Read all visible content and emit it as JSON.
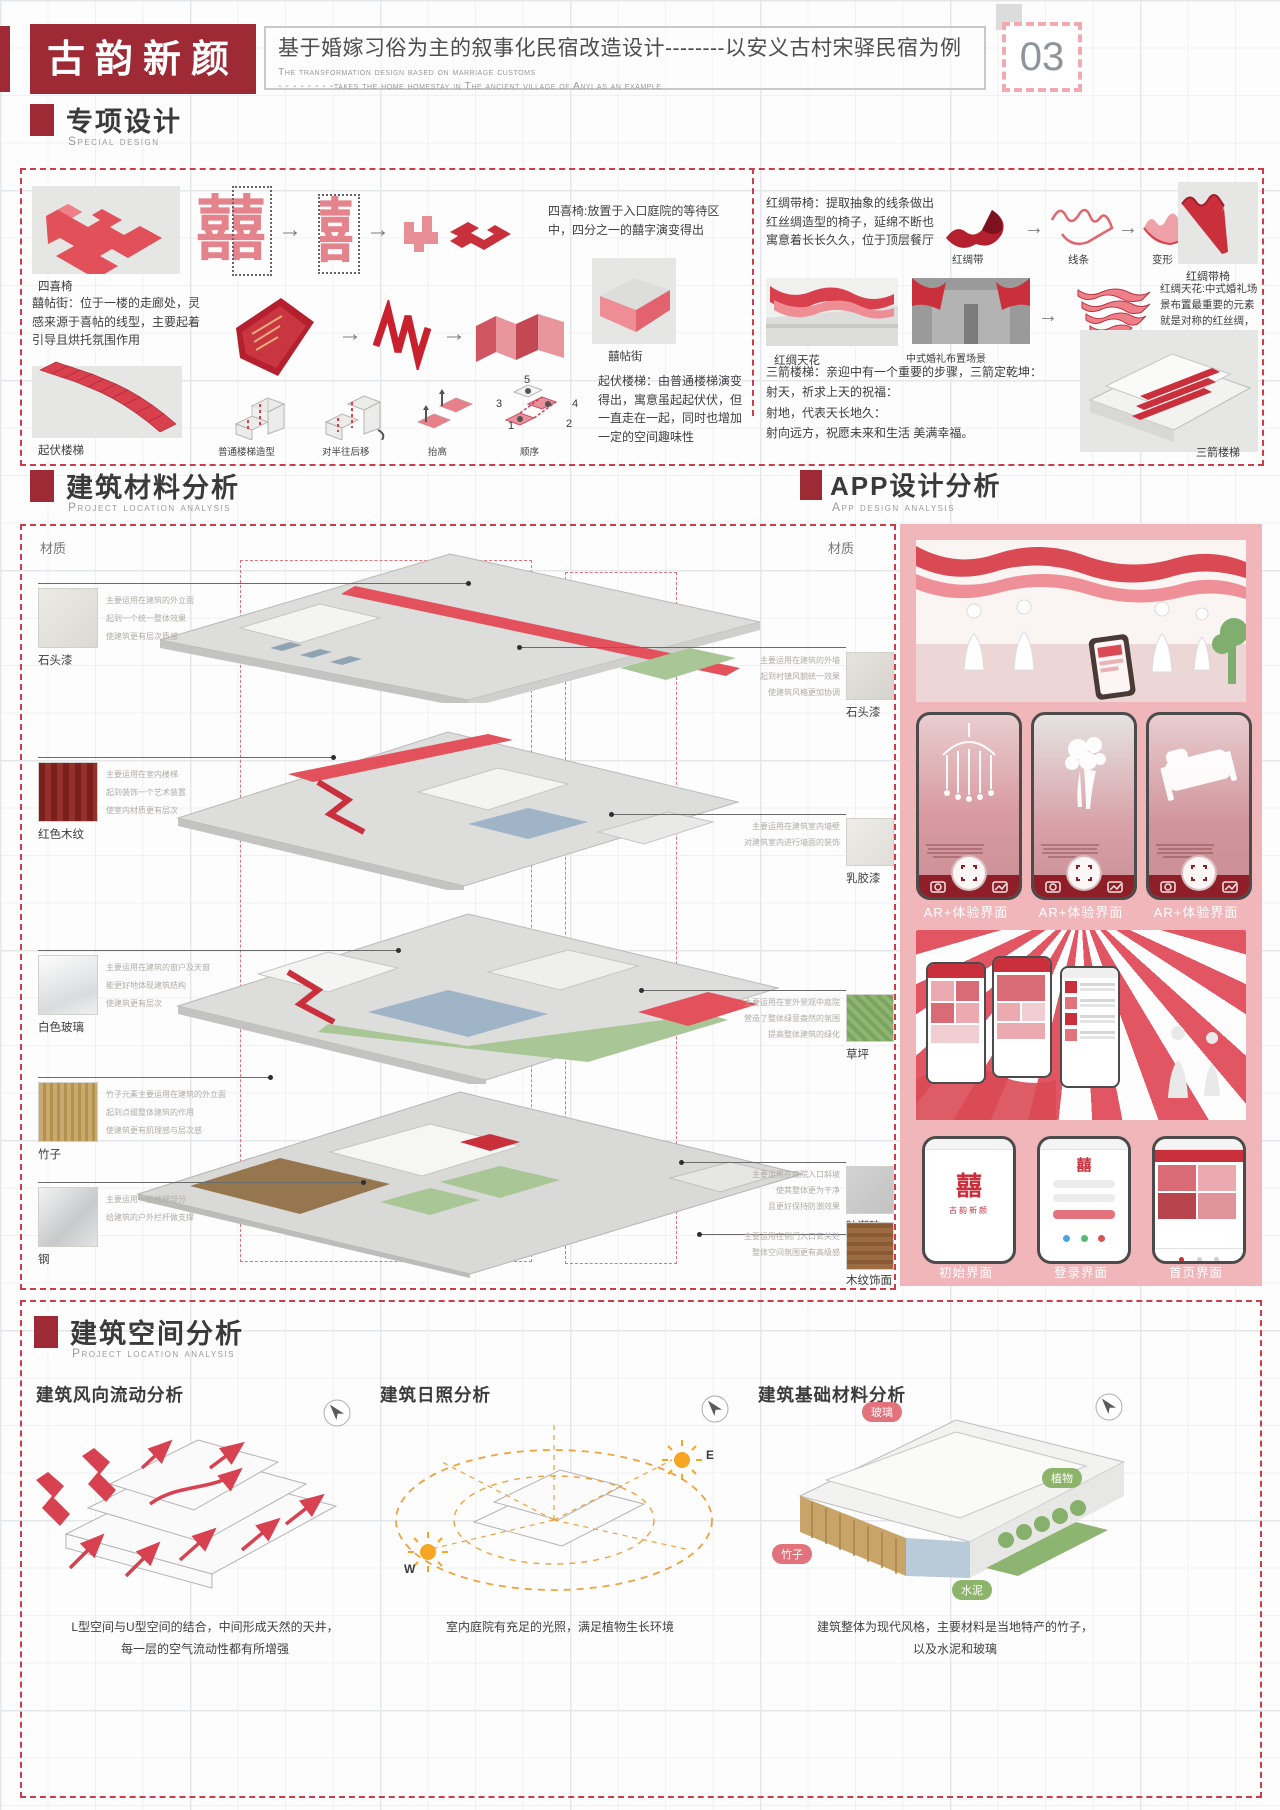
{
  "icons": {
    "arrow_right": "→"
  },
  "header": {
    "logo": "古韵新颜",
    "title_cn": "基于婚嫁习俗为主的叙事化民宿改造设计--------以安义古村宋驿民宿为例",
    "subtitle_en_1": "The transformation design based on marriage customs",
    "subtitle_en_2": "- - - - - - - -takes the home homestay in The ancient village of Anyi as an example",
    "page_number": "03"
  },
  "special": {
    "title": "专项设计",
    "subtitle": "Special design",
    "sixi": {
      "label": "四喜椅",
      "glyph": "囍",
      "desc": "四喜椅:放置于入口庭院的等待区中，四分之一的囍字演变得出"
    },
    "xitie": {
      "desc": "囍帖街：位于一楼的走廊处，灵感来源于喜帖的线型，主要起着引导且烘托氛围作用",
      "label": "囍帖街"
    },
    "qifu": {
      "label": "起伏楼梯",
      "steps": [
        "普通楼梯造型",
        "对半往后移",
        "抬高",
        "顺序"
      ],
      "numbers": [
        "1",
        "2",
        "3",
        "4",
        "5"
      ],
      "desc": "起伏楼梯：由普通楼梯演变得出，寓意虽起起伏伏，但一直走在一起，同时也增加一定的空间趣味性"
    },
    "hongchou": {
      "desc": "红绸带椅：提取抽象的线条做出红丝绸造型的椅子，延绵不断也寓意着长长久久，位于顶层餐厅",
      "steps": [
        "红绸带",
        "线条",
        "变形"
      ],
      "label": "红绸带椅"
    },
    "tianhua": {
      "label": "红绸天花",
      "scene_label": "中式婚礼布置场景",
      "evolve_label": "形状演变",
      "desc": "红绸天花:中式婚礼场景布置最重要的元素就是对称的红丝绸，意味着婚礼的开始以及隆重"
    },
    "sanjian": {
      "desc_lines": [
        "三箭楼梯：亲迎中有一个重要的步骤，三箭定乾坤：",
        "射天，祈求上天的祝福：",
        "射地，代表天长地久：",
        "射向远方，祝愿未来和生活 美满幸福。"
      ],
      "label": "三箭楼梯"
    }
  },
  "materials": {
    "title": "建筑材料分析",
    "subtitle": "Project location analysis",
    "caizhi_left": "材质",
    "caizhi_right": "材质",
    "left": [
      {
        "name": "石头漆",
        "lines": [
          "主要运用在建筑的外立面",
          "起到一个统一整体效果",
          "使建筑更有层次质感"
        ]
      },
      {
        "name": "红色木纹",
        "lines": [
          "主要运用在室内楼梯",
          "起到装饰一个艺术装置",
          "使室内材质更有层次"
        ]
      },
      {
        "name": "白色玻璃",
        "lines": [
          "主要运用在建筑的窗户及天窗",
          "能更好地体现建筑结构",
          "使建筑更有层次"
        ]
      },
      {
        "name": "竹子",
        "lines": [
          "竹子元素主要运用在建筑的外立面",
          "起到点缀整体建筑的作用",
          "使建筑更有肌理感与层次感"
        ]
      },
      {
        "name": "钢",
        "lines": [
          "主要运用一些楼梯部分",
          "给建筑的户外栏杆做支撑",
          ""
        ]
      }
    ],
    "right": [
      {
        "name": "石头漆",
        "lines": [
          "主要运用在建筑的外墙",
          "起到村镇风貌统一效果",
          "使建筑风格更加协调"
        ]
      },
      {
        "name": "乳胶漆",
        "lines": [
          "主要运用在建筑室内墙壁",
          "对建筑室内进行墙面的装饰",
          ""
        ]
      },
      {
        "name": "草坪",
        "lines": [
          "主要运用在室外景观中庭院",
          "营造了整体绿意盎然的氛围",
          "提高整体建筑的绿化"
        ]
      },
      {
        "name": "防潮砖",
        "lines": [
          "主要运用在庭院入口斜坡",
          "使其整体更为干净",
          "且更好保持防潮效果"
        ]
      },
      {
        "name": "木纹饰面",
        "lines": [
          "主要运用在侧门入口玄关处",
          "整体空间氛围更有高级感",
          ""
        ]
      }
    ]
  },
  "app": {
    "title": "APP设计分析",
    "subtitle": "App design analysis",
    "ar_labels": [
      "AR+体验界面",
      "AR+体验界面",
      "AR+体验界面"
    ],
    "screen_labels": [
      "初始界面",
      "登录界面",
      "首页界面"
    ],
    "logo_glyph": "囍",
    "logo_name": "古韵新颜"
  },
  "space": {
    "title": "建筑空间分析",
    "subtitle": "Project location analysis",
    "wind": {
      "heading": "建筑风向流动分析",
      "caption_lines": [
        "L型空间与U型空间的结合，中间形成天然的天井，",
        "每一层的空气流动性都有所增强"
      ]
    },
    "sun": {
      "heading": "建筑日照分析",
      "east": "E",
      "west": "W",
      "caption_lines": [
        "室内庭院有充足的光照，满足植物生长环境"
      ]
    },
    "base": {
      "heading": "建筑基础材料分析",
      "tags": [
        "玻璃",
        "植物",
        "竹子",
        "水泥"
      ],
      "caption_lines": [
        "建筑整体为现代风格，主要材料是当地特产的竹子，",
        "以及水泥和玻璃"
      ]
    }
  }
}
